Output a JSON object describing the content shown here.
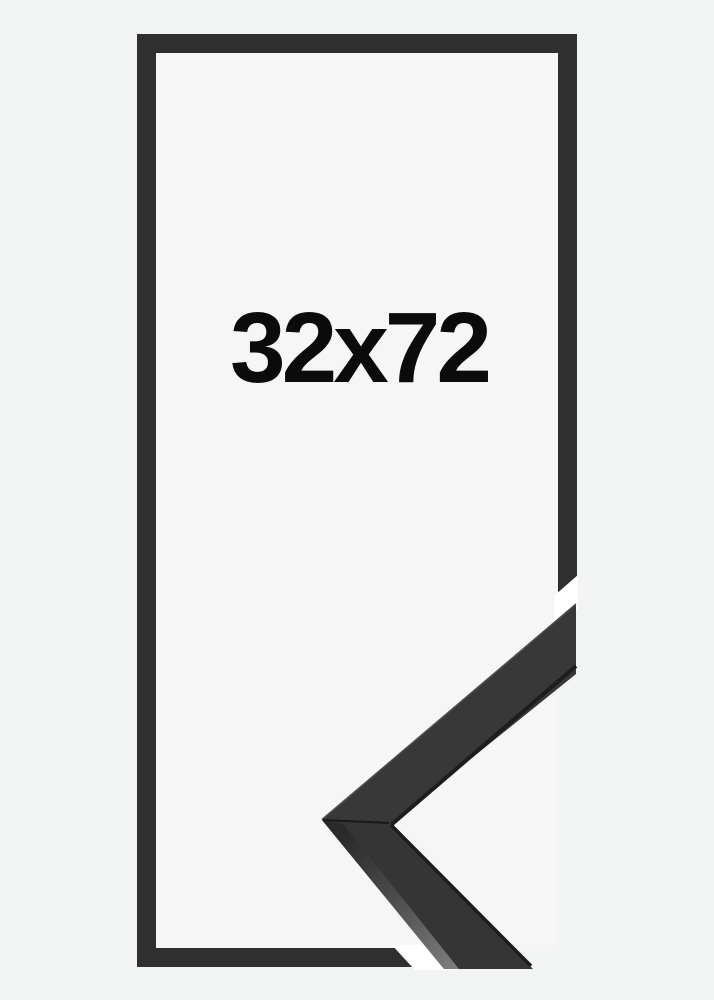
{
  "page": {
    "background": "#f2f3f3"
  },
  "product": {
    "size_label": "32x72",
    "colors": {
      "frame": "#2f2f2f",
      "frame_top_face": "#383838",
      "frame_top_face_lower": "#353535",
      "frame_edge_dark": "#1d1d1d",
      "frame_side_light": "#7b7b7b",
      "interior": "#f6f6f7",
      "photo_background": "#f3f4f4",
      "miter_gap_white": "#ffffff",
      "label_text": "#0b0b0b"
    }
  }
}
